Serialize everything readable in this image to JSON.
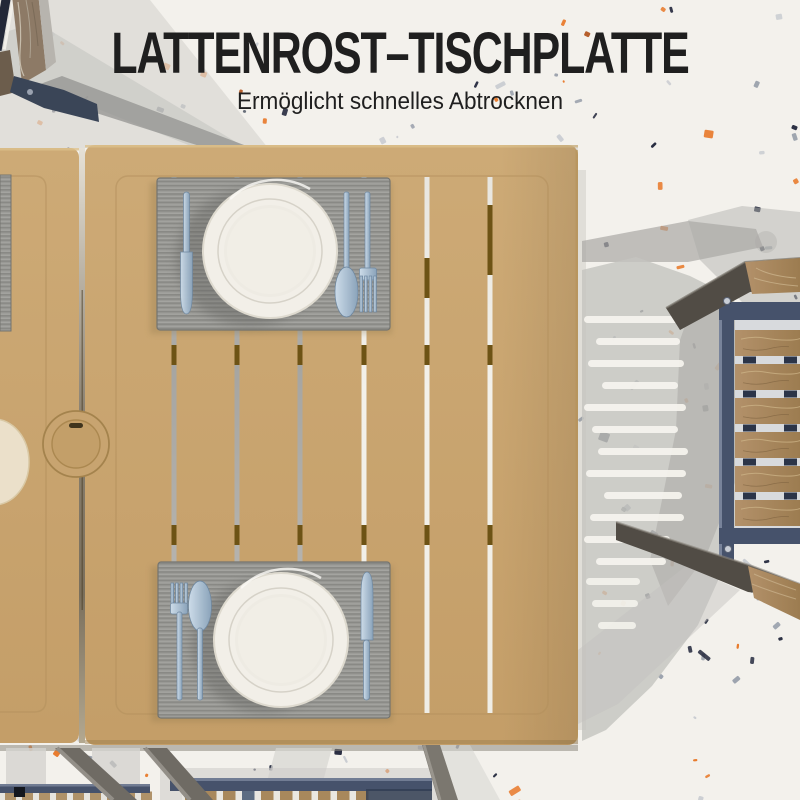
{
  "header": {
    "title": "LATTENROST–TISCHPLATTE",
    "subtitle": "Ermöglicht schnelles Abtrocknen"
  },
  "scene": {
    "type": "product-photo-top-view",
    "objects": [
      "folding-garden-table-slatted-top",
      "umbrella-hole-cap",
      "placemat-top",
      "placemat-bottom",
      "placemat-left-partial",
      "dinner-plate-top",
      "dinner-plate-bottom",
      "dinner-plate-left-partial",
      "knife",
      "fork",
      "spoon",
      "folding-chair-right",
      "folding-chair-top-left",
      "chairs-under-table-bottom",
      "table-legs",
      "terrazzo-floor",
      "cast-shadows"
    ],
    "colors": {
      "floor": "#f3f1ec",
      "ink": "#1f1f1f",
      "tan": "#c8a470",
      "tanedge": "#dcc08c",
      "tandark": "#a8854f",
      "groove": "#b2905c",
      "crossbar": "#6d5315",
      "matgray": "#9b9b97",
      "matrib": "#898985",
      "matedge": "#74746f",
      "plate": "#f2efe8",
      "platering": "#d5d1c7",
      "plateinner": "#eeebe3",
      "steel": "#9fb6cb",
      "steellight": "#cddce9",
      "steeldark": "#6d87a0",
      "slate": "#46526b",
      "slatedark": "#333e54",
      "slatelight": "#8d99ae",
      "navyclip": "#2b3448",
      "wood": "#a8885c",
      "woodlight": "#c9b28a",
      "wooddark": "#745a3b",
      "beamdark": "#514c45",
      "chairwood": "#8d7a66",
      "metal": "#6f6b64",
      "metallight": "#949088",
      "shadow": "#b7b6b3",
      "shadowlight": "#d5d4d0",
      "shadowdark": "#a5a4a0",
      "dash": "#f6f4ef"
    },
    "floor_speckle_colors": [
      "#272c40",
      "#e87a2b",
      "#99a0ab",
      "#c9ccd1",
      "#5d6470",
      "#b65f2c"
    ],
    "floor_speckle_count": 260
  }
}
